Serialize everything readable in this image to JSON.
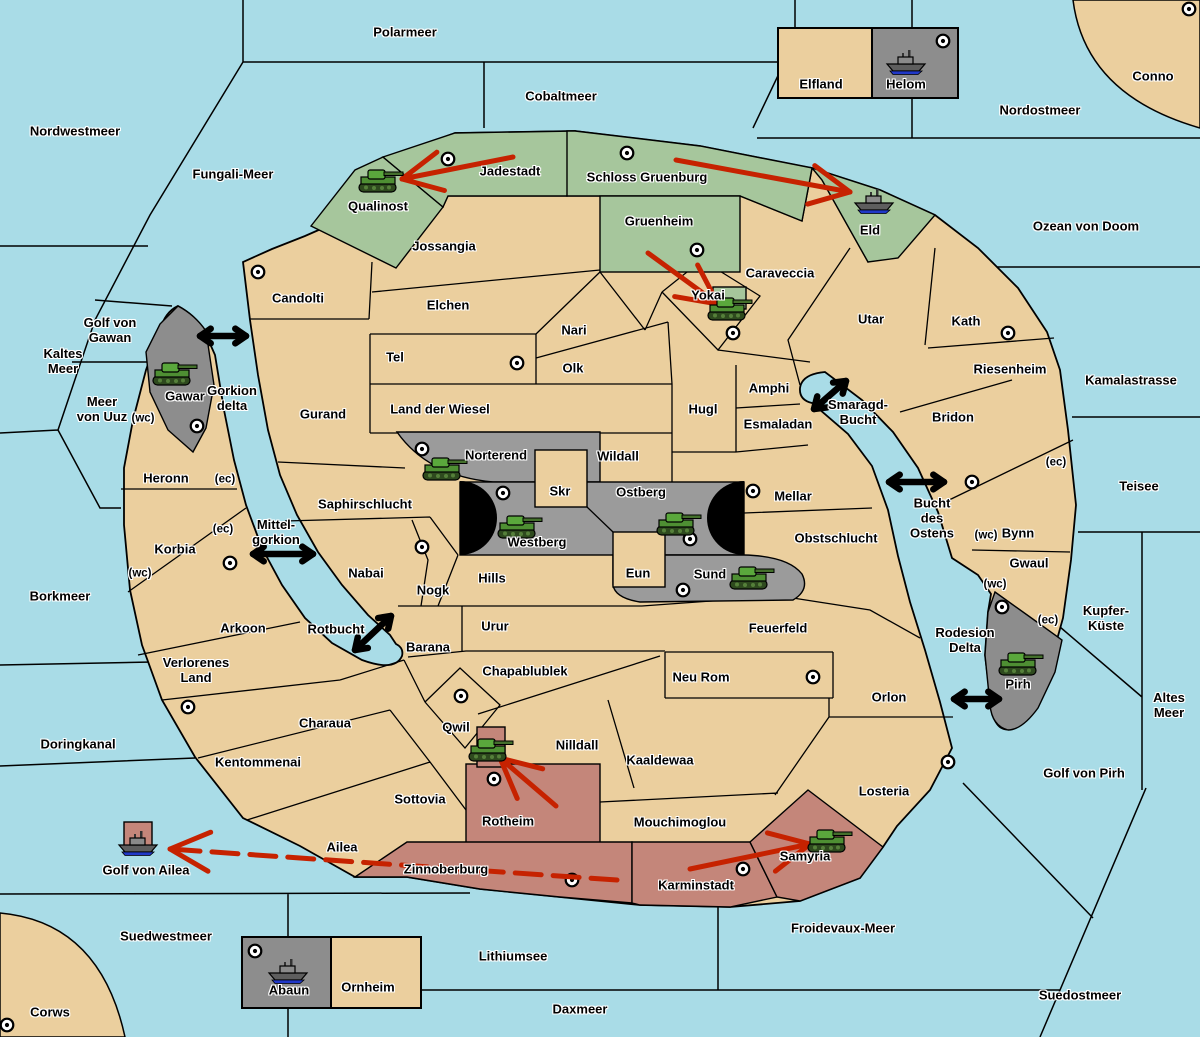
{
  "map": {
    "colors": {
      "sea": "#A9DCE7",
      "land_neutral": "#EBCF9E",
      "land_green": "#A6C69C",
      "land_gray_center": "#9B9B9B",
      "land_gray_outer": "#8D8D8D",
      "land_red": "#C4867A",
      "attack_arrow": "#C62200",
      "sea_link_arrow": "#000000",
      "border": "#000000"
    },
    "sea_regions": [
      {
        "name": "Polarmeer",
        "x": 405,
        "y": 33
      },
      {
        "name": "Cobaltmeer",
        "x": 561,
        "y": 97
      },
      {
        "name": "Nordostmeer",
        "x": 1040,
        "y": 111
      },
      {
        "name": "Nordwestmeer",
        "x": 75,
        "y": 132
      },
      {
        "name": "Fungali-Meer",
        "x": 233,
        "y": 175
      },
      {
        "name": "Ozean von Doom",
        "x": 1086,
        "y": 227
      },
      {
        "name": "Kaltes\nMeer",
        "x": 63,
        "y": 362
      },
      {
        "name": "Golf von\nGawan",
        "x": 110,
        "y": 331
      },
      {
        "name": "Meer\nvon Uuz",
        "x": 102,
        "y": 410
      },
      {
        "name": "Gorkion\ndelta",
        "x": 232,
        "y": 399
      },
      {
        "name": "Kamalastrasse",
        "x": 1131,
        "y": 381
      },
      {
        "name": "Smaragd-\nBucht",
        "x": 858,
        "y": 413
      },
      {
        "name": "Teisee",
        "x": 1139,
        "y": 487
      },
      {
        "name": "Bucht\ndes\nOstens",
        "x": 932,
        "y": 519
      },
      {
        "name": "Borkmeer",
        "x": 60,
        "y": 597
      },
      {
        "name": "Mittel-\ngorkion",
        "x": 276,
        "y": 533
      },
      {
        "name": "Rotbucht",
        "x": 336,
        "y": 630
      },
      {
        "name": "Kupfer-\nKüste",
        "x": 1106,
        "y": 619
      },
      {
        "name": "Altes\nMeer",
        "x": 1169,
        "y": 706
      },
      {
        "name": "Rodesion\nDelta",
        "x": 965,
        "y": 641
      },
      {
        "name": "Doringkanal",
        "x": 78,
        "y": 745
      },
      {
        "name": "Golf von Pirh",
        "x": 1084,
        "y": 774
      },
      {
        "name": "Golf von Ailea",
        "x": 146,
        "y": 871
      },
      {
        "name": "Suedwestmeer",
        "x": 166,
        "y": 937
      },
      {
        "name": "Froidevaux-Meer",
        "x": 843,
        "y": 929
      },
      {
        "name": "Lithiumsee",
        "x": 513,
        "y": 957
      },
      {
        "name": "Daxmeer",
        "x": 580,
        "y": 1010
      },
      {
        "name": "Suedostmeer",
        "x": 1080,
        "y": 996
      }
    ],
    "land_regions": [
      {
        "name": "Conno",
        "x": 1153,
        "y": 77,
        "owner": "neutral"
      },
      {
        "name": "Corws",
        "x": 50,
        "y": 1013,
        "owner": "neutral"
      },
      {
        "name": "Qualinost",
        "x": 378,
        "y": 207,
        "owner": "green"
      },
      {
        "name": "Jadestadt",
        "x": 510,
        "y": 172,
        "owner": "green"
      },
      {
        "name": "Schloss Gruenburg",
        "x": 647,
        "y": 178,
        "owner": "green"
      },
      {
        "name": "Gruenheim",
        "x": 659,
        "y": 222,
        "owner": "green"
      },
      {
        "name": "Eld",
        "x": 870,
        "y": 231,
        "owner": "green"
      },
      {
        "name": "Jossangia",
        "x": 444,
        "y": 247,
        "owner": "neutral"
      },
      {
        "name": "Candolti",
        "x": 298,
        "y": 299,
        "owner": "neutral"
      },
      {
        "name": "Elchen",
        "x": 448,
        "y": 306,
        "owner": "neutral"
      },
      {
        "name": "Caraveccia",
        "x": 780,
        "y": 274,
        "owner": "neutral"
      },
      {
        "name": "Yokai",
        "x": 708,
        "y": 296,
        "owner": "neutral"
      },
      {
        "name": "Utar",
        "x": 871,
        "y": 320,
        "owner": "neutral"
      },
      {
        "name": "Kath",
        "x": 966,
        "y": 322,
        "owner": "neutral"
      },
      {
        "name": "Nari",
        "x": 574,
        "y": 331,
        "owner": "neutral"
      },
      {
        "name": "Tel",
        "x": 395,
        "y": 358,
        "owner": "neutral"
      },
      {
        "name": "Olk",
        "x": 573,
        "y": 369,
        "owner": "neutral"
      },
      {
        "name": "Riesenheim",
        "x": 1010,
        "y": 370,
        "owner": "neutral"
      },
      {
        "name": "Gurand",
        "x": 323,
        "y": 415,
        "owner": "neutral"
      },
      {
        "name": "Land der Wiesel",
        "x": 440,
        "y": 410,
        "owner": "neutral"
      },
      {
        "name": "Hugl",
        "x": 703,
        "y": 410,
        "owner": "neutral"
      },
      {
        "name": "Amphi",
        "x": 769,
        "y": 389,
        "owner": "neutral"
      },
      {
        "name": "Esmaladan",
        "x": 778,
        "y": 425,
        "owner": "neutral"
      },
      {
        "name": "Bridon",
        "x": 953,
        "y": 418,
        "owner": "neutral"
      },
      {
        "name": "Gawar",
        "x": 185,
        "y": 397,
        "owner": "gray"
      },
      {
        "name": "Norterend",
        "x": 496,
        "y": 456,
        "owner": "gray"
      },
      {
        "name": "Wildall",
        "x": 618,
        "y": 457,
        "owner": "neutral"
      },
      {
        "name": "Skr",
        "x": 560,
        "y": 492,
        "owner": "neutral"
      },
      {
        "name": "Ostberg",
        "x": 641,
        "y": 493,
        "owner": "gray"
      },
      {
        "name": "Mellar",
        "x": 793,
        "y": 497,
        "owner": "neutral"
      },
      {
        "name": "Heronn",
        "x": 166,
        "y": 479,
        "owner": "neutral"
      },
      {
        "name": "Saphirschlucht",
        "x": 365,
        "y": 505,
        "owner": "neutral"
      },
      {
        "name": "Westberg",
        "x": 537,
        "y": 543,
        "owner": "gray"
      },
      {
        "name": "Obstschlucht",
        "x": 836,
        "y": 539,
        "owner": "neutral"
      },
      {
        "name": "Bynn",
        "x": 1018,
        "y": 534,
        "owner": "neutral"
      },
      {
        "name": "Korbia",
        "x": 175,
        "y": 550,
        "owner": "neutral"
      },
      {
        "name": "Gwaul",
        "x": 1029,
        "y": 564,
        "owner": "neutral"
      },
      {
        "name": "Nabai",
        "x": 366,
        "y": 574,
        "owner": "neutral"
      },
      {
        "name": "Eun",
        "x": 638,
        "y": 574,
        "owner": "neutral"
      },
      {
        "name": "Sund",
        "x": 710,
        "y": 575,
        "owner": "gray"
      },
      {
        "name": "Nogk",
        "x": 433,
        "y": 591,
        "owner": "neutral"
      },
      {
        "name": "Hills",
        "x": 492,
        "y": 579,
        "owner": "neutral"
      },
      {
        "name": "Urur",
        "x": 495,
        "y": 627,
        "owner": "neutral"
      },
      {
        "name": "Feuerfeld",
        "x": 778,
        "y": 629,
        "owner": "neutral"
      },
      {
        "name": "Arkoon",
        "x": 243,
        "y": 629,
        "owner": "neutral"
      },
      {
        "name": "Barana",
        "x": 428,
        "y": 648,
        "owner": "neutral"
      },
      {
        "name": "Chapablublek",
        "x": 525,
        "y": 672,
        "owner": "neutral"
      },
      {
        "name": "Neu Rom",
        "x": 701,
        "y": 678,
        "owner": "neutral"
      },
      {
        "name": "Verlorenes\nLand",
        "x": 196,
        "y": 671,
        "owner": "neutral"
      },
      {
        "name": "Orlon",
        "x": 889,
        "y": 698,
        "owner": "neutral"
      },
      {
        "name": "Pirh",
        "x": 1018,
        "y": 685,
        "owner": "gray"
      },
      {
        "name": "Charaua",
        "x": 325,
        "y": 724,
        "owner": "neutral"
      },
      {
        "name": "Qwil",
        "x": 456,
        "y": 728,
        "owner": "neutral"
      },
      {
        "name": "Nilldall",
        "x": 577,
        "y": 746,
        "owner": "neutral"
      },
      {
        "name": "Kaaldewaa",
        "x": 660,
        "y": 761,
        "owner": "neutral"
      },
      {
        "name": "Kentommenai",
        "x": 258,
        "y": 763,
        "owner": "neutral"
      },
      {
        "name": "Sottovia",
        "x": 420,
        "y": 800,
        "owner": "neutral"
      },
      {
        "name": "Rotheim",
        "x": 508,
        "y": 822,
        "owner": "red"
      },
      {
        "name": "Mouchimoglou",
        "x": 680,
        "y": 823,
        "owner": "neutral"
      },
      {
        "name": "Losteria",
        "x": 884,
        "y": 792,
        "owner": "neutral"
      },
      {
        "name": "Ailea",
        "x": 342,
        "y": 848,
        "owner": "neutral"
      },
      {
        "name": "Zinnoberburg",
        "x": 446,
        "y": 870,
        "owner": "red"
      },
      {
        "name": "Karminstadt",
        "x": 696,
        "y": 886,
        "owner": "red"
      },
      {
        "name": "Samyria",
        "x": 805,
        "y": 857,
        "owner": "red"
      },
      {
        "name": "Elfland",
        "x": 821,
        "y": 85,
        "owner": "neutral"
      },
      {
        "name": "Helom",
        "x": 906,
        "y": 85,
        "owner": "gray"
      },
      {
        "name": "Abaun",
        "x": 289,
        "y": 991,
        "owner": "gray"
      },
      {
        "name": "Ornheim",
        "x": 368,
        "y": 988,
        "owner": "neutral"
      }
    ],
    "coast_markers": [
      {
        "text": "(wc)",
        "x": 143,
        "y": 419
      },
      {
        "text": "(ec)",
        "x": 225,
        "y": 480
      },
      {
        "text": "(ec)",
        "x": 223,
        "y": 530
      },
      {
        "text": "(wc)",
        "x": 140,
        "y": 574
      },
      {
        "text": "(ec)",
        "x": 1056,
        "y": 463
      },
      {
        "text": "(wc)",
        "x": 986,
        "y": 536
      },
      {
        "text": "(wc)",
        "x": 995,
        "y": 585
      },
      {
        "text": "(ec)",
        "x": 1048,
        "y": 621
      }
    ],
    "city_markers": [
      {
        "region": "Jadestadt",
        "x": 448,
        "y": 159
      },
      {
        "region": "Schloss Gruenburg",
        "x": 627,
        "y": 153
      },
      {
        "region": "Gruenheim",
        "x": 697,
        "y": 250
      },
      {
        "region": "Yokai",
        "x": 733,
        "y": 333
      },
      {
        "region": "Helom",
        "x": 943,
        "y": 41
      },
      {
        "region": "Conno",
        "x": 1189,
        "y": 9
      },
      {
        "region": "Candolti",
        "x": 258,
        "y": 272
      },
      {
        "region": "Tel",
        "x": 517,
        "y": 363
      },
      {
        "region": "Kath",
        "x": 1008,
        "y": 333
      },
      {
        "region": "Gawar",
        "x": 197,
        "y": 426
      },
      {
        "region": "Norterend",
        "x": 422,
        "y": 449
      },
      {
        "region": "Westberg",
        "x": 503,
        "y": 493
      },
      {
        "region": "Ostberg",
        "x": 690,
        "y": 539
      },
      {
        "region": "Sund",
        "x": 683,
        "y": 590
      },
      {
        "region": "Mellar",
        "x": 753,
        "y": 491
      },
      {
        "region": "Saphirschlucht",
        "x": 422,
        "y": 547
      },
      {
        "region": "Korbia",
        "x": 230,
        "y": 563
      },
      {
        "region": "Bynn",
        "x": 972,
        "y": 482
      },
      {
        "region": "Charaua",
        "x": 188,
        "y": 707
      },
      {
        "region": "Qwil",
        "x": 461,
        "y": 696
      },
      {
        "region": "Rotheim",
        "x": 494,
        "y": 779
      },
      {
        "region": "Zinnoberburg",
        "x": 572,
        "y": 880
      },
      {
        "region": "Karminstadt",
        "x": 743,
        "y": 869
      },
      {
        "region": "Neu Rom",
        "x": 813,
        "y": 677
      },
      {
        "region": "Losteria",
        "x": 948,
        "y": 762
      },
      {
        "region": "Pirh",
        "x": 1002,
        "y": 607
      },
      {
        "region": "Abaun",
        "x": 255,
        "y": 951
      },
      {
        "region": "Corws",
        "x": 7,
        "y": 1025
      }
    ],
    "units": [
      {
        "type": "tank",
        "region": "Qualinost",
        "x": 380,
        "y": 181
      },
      {
        "type": "tank",
        "region": "Gawar",
        "x": 174,
        "y": 374
      },
      {
        "type": "tank",
        "region": "Yokai",
        "x": 729,
        "y": 309
      },
      {
        "type": "tank",
        "region": "Norterend",
        "x": 444,
        "y": 469
      },
      {
        "type": "tank",
        "region": "Westberg",
        "x": 519,
        "y": 527
      },
      {
        "type": "tank",
        "region": "Ostberg",
        "x": 678,
        "y": 524
      },
      {
        "type": "tank",
        "region": "Sund",
        "x": 751,
        "y": 578
      },
      {
        "type": "tank",
        "region": "Pirh",
        "x": 1020,
        "y": 664
      },
      {
        "type": "tank",
        "region": "Qwil",
        "x": 490,
        "y": 750
      },
      {
        "type": "tank",
        "region": "Samyria",
        "x": 829,
        "y": 841
      },
      {
        "type": "ship",
        "region": "Helom",
        "x": 906,
        "y": 62
      },
      {
        "type": "ship",
        "region": "Eld",
        "x": 874,
        "y": 201
      },
      {
        "type": "ship",
        "region": "Golf von Ailea",
        "x": 138,
        "y": 843
      },
      {
        "type": "ship",
        "region": "Abaun",
        "x": 288,
        "y": 971
      }
    ],
    "attack_arrows": [
      {
        "x1": 513,
        "y1": 157,
        "x2": 402,
        "y2": 179,
        "dashed": false
      },
      {
        "x1": 676,
        "y1": 160,
        "x2": 850,
        "y2": 192,
        "dashed": false
      },
      {
        "x1": 648,
        "y1": 253,
        "x2": 718,
        "y2": 304,
        "dashed": false
      },
      {
        "x1": 556,
        "y1": 806,
        "x2": 500,
        "y2": 758,
        "dashed": false
      },
      {
        "x1": 690,
        "y1": 869,
        "x2": 810,
        "y2": 844,
        "dashed": false
      },
      {
        "x1": 617,
        "y1": 880,
        "x2": 170,
        "y2": 849,
        "dashed": true
      }
    ],
    "sea_links": [
      {
        "x1": 200,
        "y1": 336,
        "x2": 246,
        "y2": 336
      },
      {
        "x1": 253,
        "y1": 554,
        "x2": 313,
        "y2": 554
      },
      {
        "x1": 355,
        "y1": 650,
        "x2": 391,
        "y2": 616
      },
      {
        "x1": 814,
        "y1": 409,
        "x2": 846,
        "y2": 381
      },
      {
        "x1": 889,
        "y1": 482,
        "x2": 944,
        "y2": 482
      },
      {
        "x1": 954,
        "y1": 699,
        "x2": 999,
        "y2": 699
      }
    ]
  }
}
